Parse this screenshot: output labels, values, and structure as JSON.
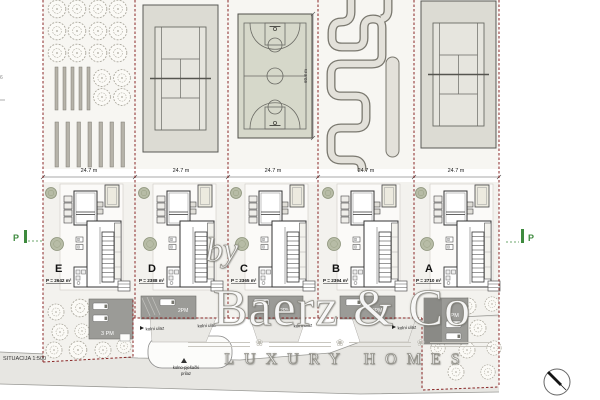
{
  "scale_label": "SITUACIJA 1:500",
  "edge_note": "6",
  "plot_width_labels": [
    "24.7 m",
    "24.7 m",
    "24.7 m",
    "24.7 m",
    "24.7 m"
  ],
  "court_height_label": "60.8 m",
  "villas": [
    {
      "label": "E",
      "area": "P = 2642 m²",
      "parking": "3 PM"
    },
    {
      "label": "D",
      "area": "P = 2388 m²",
      "parking": "2PM"
    },
    {
      "label": "C",
      "area": "P = 2365 m²",
      "parking": "2PM"
    },
    {
      "label": "B",
      "area": "P = 2394 m²",
      "parking": "2PM"
    },
    {
      "label": "A",
      "area": "P = 2710 m²",
      "parking": "3 PM"
    }
  ],
  "road": {
    "entrance_label": "kolni ulaz",
    "pedestrian_label_line1": "kolno-pješački",
    "pedestrian_label_line2": "prilaz"
  },
  "markers": {
    "parking": "P"
  },
  "watermark": {
    "prefix": "by",
    "name": "Baerz & Co",
    "tagline": "LUXURY HOMES"
  },
  "colors": {
    "boundary": "#8a2727",
    "green_marker": "#3e8a3e",
    "parking_fill": "#9b9b97",
    "road_fill": "#e7e6e2",
    "court_fill": "#dcdbd3"
  }
}
